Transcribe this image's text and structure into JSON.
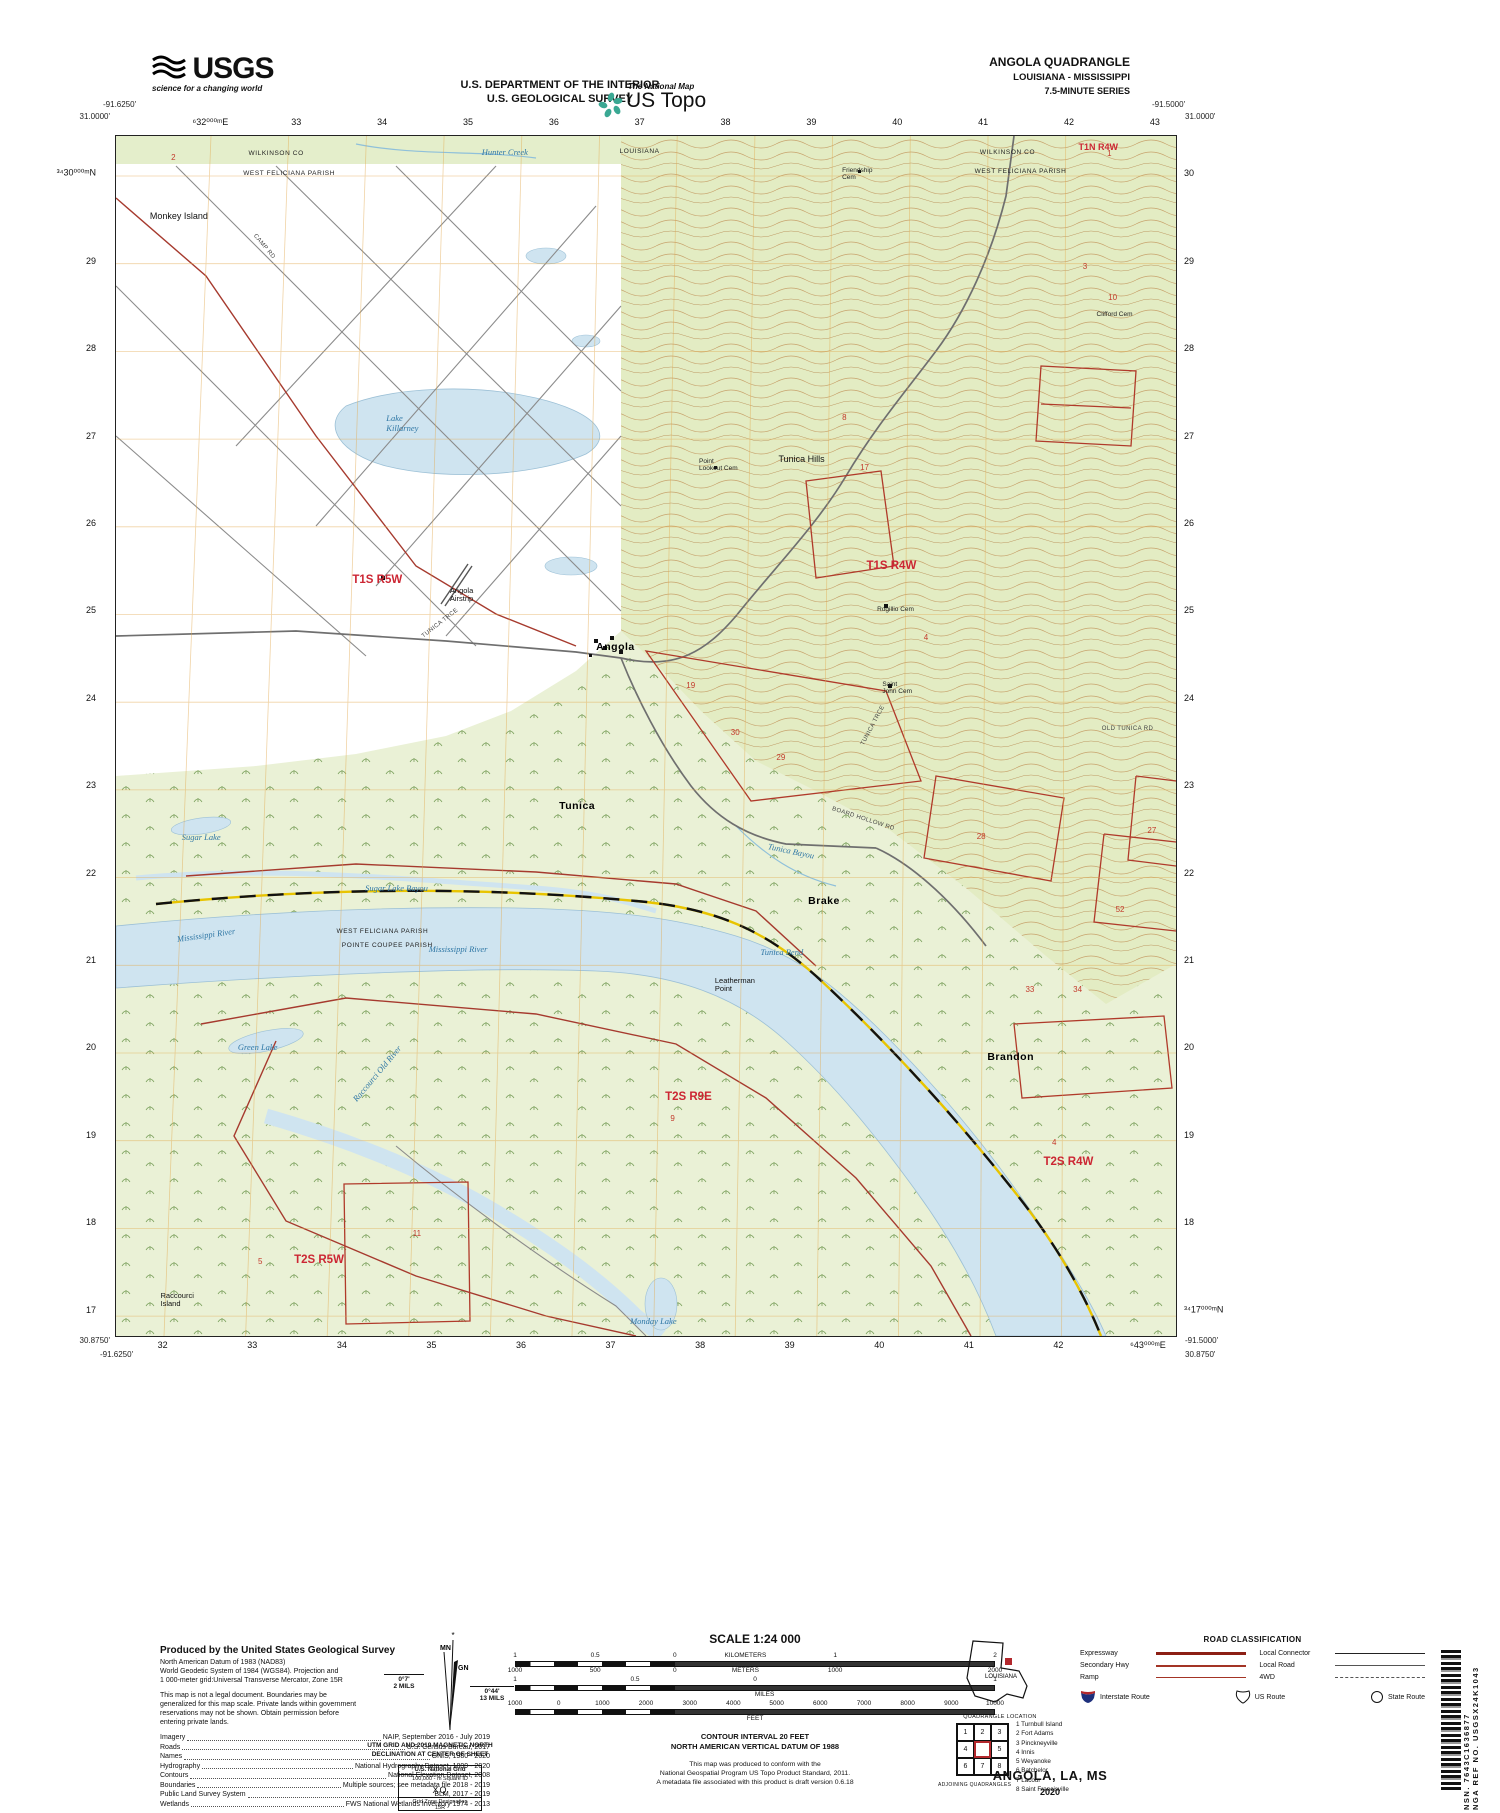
{
  "colors": {
    "woodland": "#e3ecc3",
    "wetland": "#eaf1d6",
    "water": "#cfe4f0",
    "contour": "#c49a62",
    "boundary_red": "#a63a2e",
    "section_red": "#c33a2c",
    "grid_orange": "#e2a94f",
    "interstate_blue": "#1d2f7c",
    "interstate_red": "#b3282d"
  },
  "header": {
    "usgs": {
      "brand": "USGS",
      "tagline": "science for a changing world"
    },
    "dept_line1": "U.S. DEPARTMENT OF THE INTERIOR",
    "dept_line2": "U.S. GEOLOGICAL SURVEY",
    "ustopo": {
      "tagline": "The National Map",
      "brand": "US Topo"
    },
    "quad": {
      "title": "ANGOLA QUADRANGLE",
      "subtitle": "LOUISIANA - MISSISSIPPI",
      "series": "7.5-MINUTE SERIES"
    }
  },
  "map": {
    "corners": {
      "top_left_lat": "31.0000'",
      "top_left_lon": "-91.6250'",
      "top_right_lat": "31.0000'",
      "top_right_lon": "-91.5000'",
      "bottom_left_lat": "30.8750'",
      "bottom_left_lon": "-91.6250'",
      "bottom_right_lat": "30.8750'",
      "bottom_right_lon": "-91.5000'"
    },
    "grid_top": [
      "⁶32⁰⁰⁰ᵐE",
      "33",
      "34",
      "35",
      "36",
      "37",
      "38",
      "39",
      "40",
      "41",
      "42",
      "43"
    ],
    "grid_bottom": [
      "32",
      "33",
      "34",
      "35",
      "36",
      "37",
      "38",
      "39",
      "40",
      "41",
      "42",
      "⁶43⁰⁰⁰ᵐE"
    ],
    "grid_left": [
      "³⁴30⁰⁰⁰ᵐN",
      "29",
      "28",
      "27",
      "26",
      "25",
      "24",
      "23",
      "22",
      "21",
      "20",
      "19",
      "18",
      "17"
    ],
    "grid_right": [
      "30",
      "29",
      "28",
      "27",
      "26",
      "25",
      "24",
      "23",
      "22",
      "21",
      "20",
      "19",
      "18",
      "³⁴17⁰⁰⁰ᵐN"
    ],
    "labels": [
      {
        "t": "WILKINSON CO",
        "x": 12.5,
        "y": 1.2,
        "c": "county"
      },
      {
        "t": "WEST FELICIANA PARISH",
        "x": 12.0,
        "y": 2.8,
        "c": "county"
      },
      {
        "t": "Hunter Creek",
        "x": 34.5,
        "y": 1.0,
        "c": "water"
      },
      {
        "t": "LOUISIANA",
        "x": 47.5,
        "y": 1.0,
        "c": "county"
      },
      {
        "t": "Friendship\nCem",
        "x": 68.5,
        "y": 2.6,
        "c": "cem"
      },
      {
        "t": "WILKINSON CO",
        "x": 81.5,
        "y": 1.1,
        "c": "county"
      },
      {
        "t": "WEST FELICIANA PARISH",
        "x": 81.0,
        "y": 2.7,
        "c": "county"
      },
      {
        "t": "T1N R4W",
        "x": 90.8,
        "y": 0.6,
        "c": "twp"
      },
      {
        "t": "2",
        "x": 5.2,
        "y": 1.5,
        "c": "sec"
      },
      {
        "t": "1",
        "x": 93.5,
        "y": 1.2,
        "c": "sec"
      },
      {
        "t": "Monkey Island",
        "x": 3.2,
        "y": 6.3,
        "c": "place"
      },
      {
        "t": "3",
        "x": 91.2,
        "y": 10.6,
        "c": "sec"
      },
      {
        "t": "10",
        "x": 93.6,
        "y": 13.2,
        "c": "sec"
      },
      {
        "t": "Clifford Cem",
        "x": 92.5,
        "y": 14.6,
        "c": "cem"
      },
      {
        "t": "CAMP RD",
        "x": 13.0,
        "y": 8.0,
        "c": "road",
        "r": 50
      },
      {
        "t": "Lake\nKillarney",
        "x": 25.5,
        "y": 23.2,
        "c": "water"
      },
      {
        "t": "8",
        "x": 68.5,
        "y": 23.2,
        "c": "sec"
      },
      {
        "t": "Tunica Hills",
        "x": 62.5,
        "y": 26.6,
        "c": "place"
      },
      {
        "t": "17",
        "x": 70.2,
        "y": 27.3,
        "c": "sec"
      },
      {
        "t": "Point\nLookout Cem",
        "x": 55.0,
        "y": 26.8,
        "c": "cem"
      },
      {
        "t": "T1S R4W",
        "x": 70.8,
        "y": 35.3,
        "c": "twp-big"
      },
      {
        "t": "T1S R5W",
        "x": 22.3,
        "y": 36.5,
        "c": "twp-big"
      },
      {
        "t": "Angola\nAirstrip",
        "x": 31.5,
        "y": 37.6,
        "c": "place-sm"
      },
      {
        "t": "TUNICA TRCE",
        "x": 29.0,
        "y": 41.5,
        "c": "road",
        "r": -38
      },
      {
        "t": "Rogillio Cem",
        "x": 71.8,
        "y": 39.2,
        "c": "cem"
      },
      {
        "t": "Angola",
        "x": 45.3,
        "y": 42.2,
        "c": "town"
      },
      {
        "t": "Saint\nJohn Cem",
        "x": 72.3,
        "y": 45.4,
        "c": "cem"
      },
      {
        "t": "19",
        "x": 53.8,
        "y": 45.5,
        "c": "sec"
      },
      {
        "t": "4",
        "x": 76.2,
        "y": 41.5,
        "c": "sec"
      },
      {
        "t": "OLD TUNICA RD",
        "x": 93.0,
        "y": 49.2,
        "c": "road"
      },
      {
        "t": "BOARD HOLLOW RD",
        "x": 67.5,
        "y": 55.8,
        "c": "road",
        "r": 18
      },
      {
        "t": "30",
        "x": 58.0,
        "y": 49.4,
        "c": "sec"
      },
      {
        "t": "29",
        "x": 62.3,
        "y": 51.5,
        "c": "sec"
      },
      {
        "t": "TUNICA TRCE",
        "x": 70.5,
        "y": 50.5,
        "c": "road",
        "r": -62
      },
      {
        "t": "Tunica",
        "x": 41.8,
        "y": 55.4,
        "c": "town"
      },
      {
        "t": "Tunica Bayou",
        "x": 61.5,
        "y": 58.8,
        "c": "water",
        "r": 12
      },
      {
        "t": "28",
        "x": 81.2,
        "y": 58.1,
        "c": "sec"
      },
      {
        "t": "27",
        "x": 97.3,
        "y": 57.6,
        "c": "sec"
      },
      {
        "t": "Sugar Lake",
        "x": 6.2,
        "y": 58.1,
        "c": "water"
      },
      {
        "t": "Sugar Lake Bayou",
        "x": 23.5,
        "y": 62.3,
        "c": "water"
      },
      {
        "t": "Brake",
        "x": 65.3,
        "y": 63.3,
        "c": "town"
      },
      {
        "t": "52",
        "x": 94.3,
        "y": 64.2,
        "c": "sec"
      },
      {
        "t": "WEST FELICIANA PARISH",
        "x": 20.8,
        "y": 66.0,
        "c": "county"
      },
      {
        "t": "POINTE COUPEE PARISH",
        "x": 21.3,
        "y": 67.2,
        "c": "county"
      },
      {
        "t": "Mississippi River",
        "x": 5.8,
        "y": 66.6,
        "c": "water",
        "r": -8
      },
      {
        "t": "Mississippi River",
        "x": 29.5,
        "y": 67.4,
        "c": "water"
      },
      {
        "t": "Tunica Bend",
        "x": 60.8,
        "y": 67.7,
        "c": "water"
      },
      {
        "t": "Leatherman\nPoint",
        "x": 56.5,
        "y": 70.1,
        "c": "place-sm"
      },
      {
        "t": "Green Lake",
        "x": 11.5,
        "y": 75.6,
        "c": "water"
      },
      {
        "t": "Brandon",
        "x": 82.2,
        "y": 76.3,
        "c": "town"
      },
      {
        "t": "33",
        "x": 85.8,
        "y": 70.8,
        "c": "sec"
      },
      {
        "t": "34",
        "x": 90.3,
        "y": 70.8,
        "c": "sec"
      },
      {
        "t": "Raccourci Old River",
        "x": 22.5,
        "y": 80.0,
        "c": "water",
        "r": -50
      },
      {
        "t": "T2S R9E",
        "x": 51.8,
        "y": 79.6,
        "c": "twp-big"
      },
      {
        "t": "9",
        "x": 52.3,
        "y": 81.6,
        "c": "sec"
      },
      {
        "t": "4",
        "x": 88.3,
        "y": 83.6,
        "c": "sec"
      },
      {
        "t": "T2S R4W",
        "x": 87.5,
        "y": 85.0,
        "c": "twp-big"
      },
      {
        "t": "11",
        "x": 28.0,
        "y": 91.2,
        "c": "sec"
      },
      {
        "t": "5",
        "x": 13.4,
        "y": 93.5,
        "c": "sec"
      },
      {
        "t": "T2S R5W",
        "x": 16.8,
        "y": 93.2,
        "c": "twp-big"
      },
      {
        "t": "Raccourci\nIsland",
        "x": 4.2,
        "y": 96.3,
        "c": "place-sm"
      },
      {
        "t": "Monday Lake",
        "x": 48.5,
        "y": 98.4,
        "c": "water"
      }
    ]
  },
  "footer": {
    "credits": {
      "title": "Produced by the United States Geological Survey",
      "datum": "North American Datum of 1983 (NAD83)\nWorld Geodetic System of 1984 (WGS84).  Projection and\n1 000-meter grid:Universal Transverse Mercator, Zone 15R",
      "disclaimer": "This map is not a legal document. Boundaries may be\ngeneralized for this map scale. Private lands within government\nreservations may not be shown. Obtain permission before\nentering private lands.",
      "rows": [
        {
          "k": "Imagery",
          "v": "NAIP, September 2016 - July 2019"
        },
        {
          "k": "Roads",
          "v": "U.S. Census Bureau, 2017"
        },
        {
          "k": "Names",
          "v": "GNIS, 1980 - 2020"
        },
        {
          "k": "Hydrography",
          "v": "National Hydrography Dataset, 1899 - 2020"
        },
        {
          "k": "Contours",
          "v": "National Elevation Dataset, 2008"
        },
        {
          "k": "Boundaries",
          "v": "Multiple sources; see metadata file 2018 - 2019"
        },
        {
          "k": "Public Land Survey System",
          "v": "BLM, 2017 - 2019"
        },
        {
          "k": "Wetlands",
          "v": "FWS National Wetlands Inventory 1974 - 2013"
        }
      ]
    },
    "declination": {
      "mn": "MN",
      "gn": "GN",
      "star": "*",
      "left_value": "0°7'",
      "left_unit": "2 MILS",
      "right_value": "0°44'",
      "right_unit": "13 MILS",
      "caption": "UTM GRID AND 2019 MAGNETIC NORTH\nDECLINATION AT CENTER OF SHEET"
    },
    "natgrid": {
      "title": "U.S. National Grid",
      "sub": "100,000 - m Square ID",
      "square": "XQ",
      "zone_label": "Grid Zone Designation",
      "zone": "15R"
    },
    "scale": {
      "title": "SCALE 1:24 000",
      "bars": [
        {
          "above": {
            "values": [
              "1",
              "0.5",
              "0",
              "KILOMETERS",
              "1",
              "2"
            ],
            "pos": [
              0,
              16.7,
              33.3,
              48,
              66.7,
              100
            ]
          },
          "below": {
            "values": [
              "1000",
              "500",
              "0",
              "METERS",
              "1000",
              "2000"
            ],
            "pos": [
              0,
              16.7,
              33.3,
              48,
              66.7,
              100
            ]
          }
        },
        {
          "above": {
            "values": [
              "1",
              "0.5",
              "0",
              "1"
            ],
            "pos": [
              0,
              25,
              50,
              100
            ]
          },
          "below": {
            "values": [
              "MILES"
            ],
            "pos": [
              52
            ]
          }
        },
        {
          "above": {
            "values": [
              "1000",
              "0",
              "1000",
              "2000",
              "3000",
              "4000",
              "5000",
              "6000",
              "7000",
              "8000",
              "9000",
              "10000"
            ],
            "pos": [
              0,
              9.1,
              18.2,
              27.3,
              36.4,
              45.5,
              54.5,
              63.6,
              72.7,
              81.8,
              90.9,
              100
            ]
          },
          "below": {
            "values": [
              "FEET"
            ],
            "pos": [
              50
            ]
          }
        }
      ],
      "contour_note": "CONTOUR INTERVAL 20 FEET\nNORTH AMERICAN VERTICAL DATUM OF 1988",
      "conformance": "This map was produced to conform with the\nNational Geospatial Program US Topo Product Standard, 2011.\nA metadata file associated with this product is draft version 0.6.18"
    },
    "location": {
      "state_label": "LOUISIANA",
      "caption": "QUADRANGLE LOCATION"
    },
    "adjoining": {
      "cells": [
        "1",
        "2",
        "3",
        "4",
        "",
        "5",
        "6",
        "7",
        "8"
      ],
      "names": [
        "1 Turnbull Island",
        "2 Fort Adams",
        "3 Pinckneyville",
        "4 Innis",
        "5 Weyanoke",
        "6 Batchelor",
        "7 Lacour",
        "8 Saint Francisville"
      ],
      "caption": "ADJOINING QUADRANGLES"
    },
    "roads": {
      "title": "ROAD CLASSIFICATION",
      "left": [
        {
          "label": "Expressway",
          "cls": "expressway"
        },
        {
          "label": "Secondary Hwy",
          "cls": "secondary"
        },
        {
          "label": "Ramp",
          "cls": "ramp"
        }
      ],
      "right": [
        {
          "label": "Local Connector",
          "cls": "connector"
        },
        {
          "label": "Local Road",
          "cls": "local"
        },
        {
          "label": "4WD",
          "cls": "fourwd"
        }
      ],
      "symbols": [
        {
          "label": "Interstate Route"
        },
        {
          "label": "US Route"
        },
        {
          "label": "State Route"
        }
      ]
    },
    "title_block": {
      "name": "ANGOLA,  LA, MS",
      "year": "2020"
    }
  },
  "barcode": {
    "line1": "NSN.  7643C1636877",
    "line2": "NGA REF NO.  USGSX24K1043"
  }
}
